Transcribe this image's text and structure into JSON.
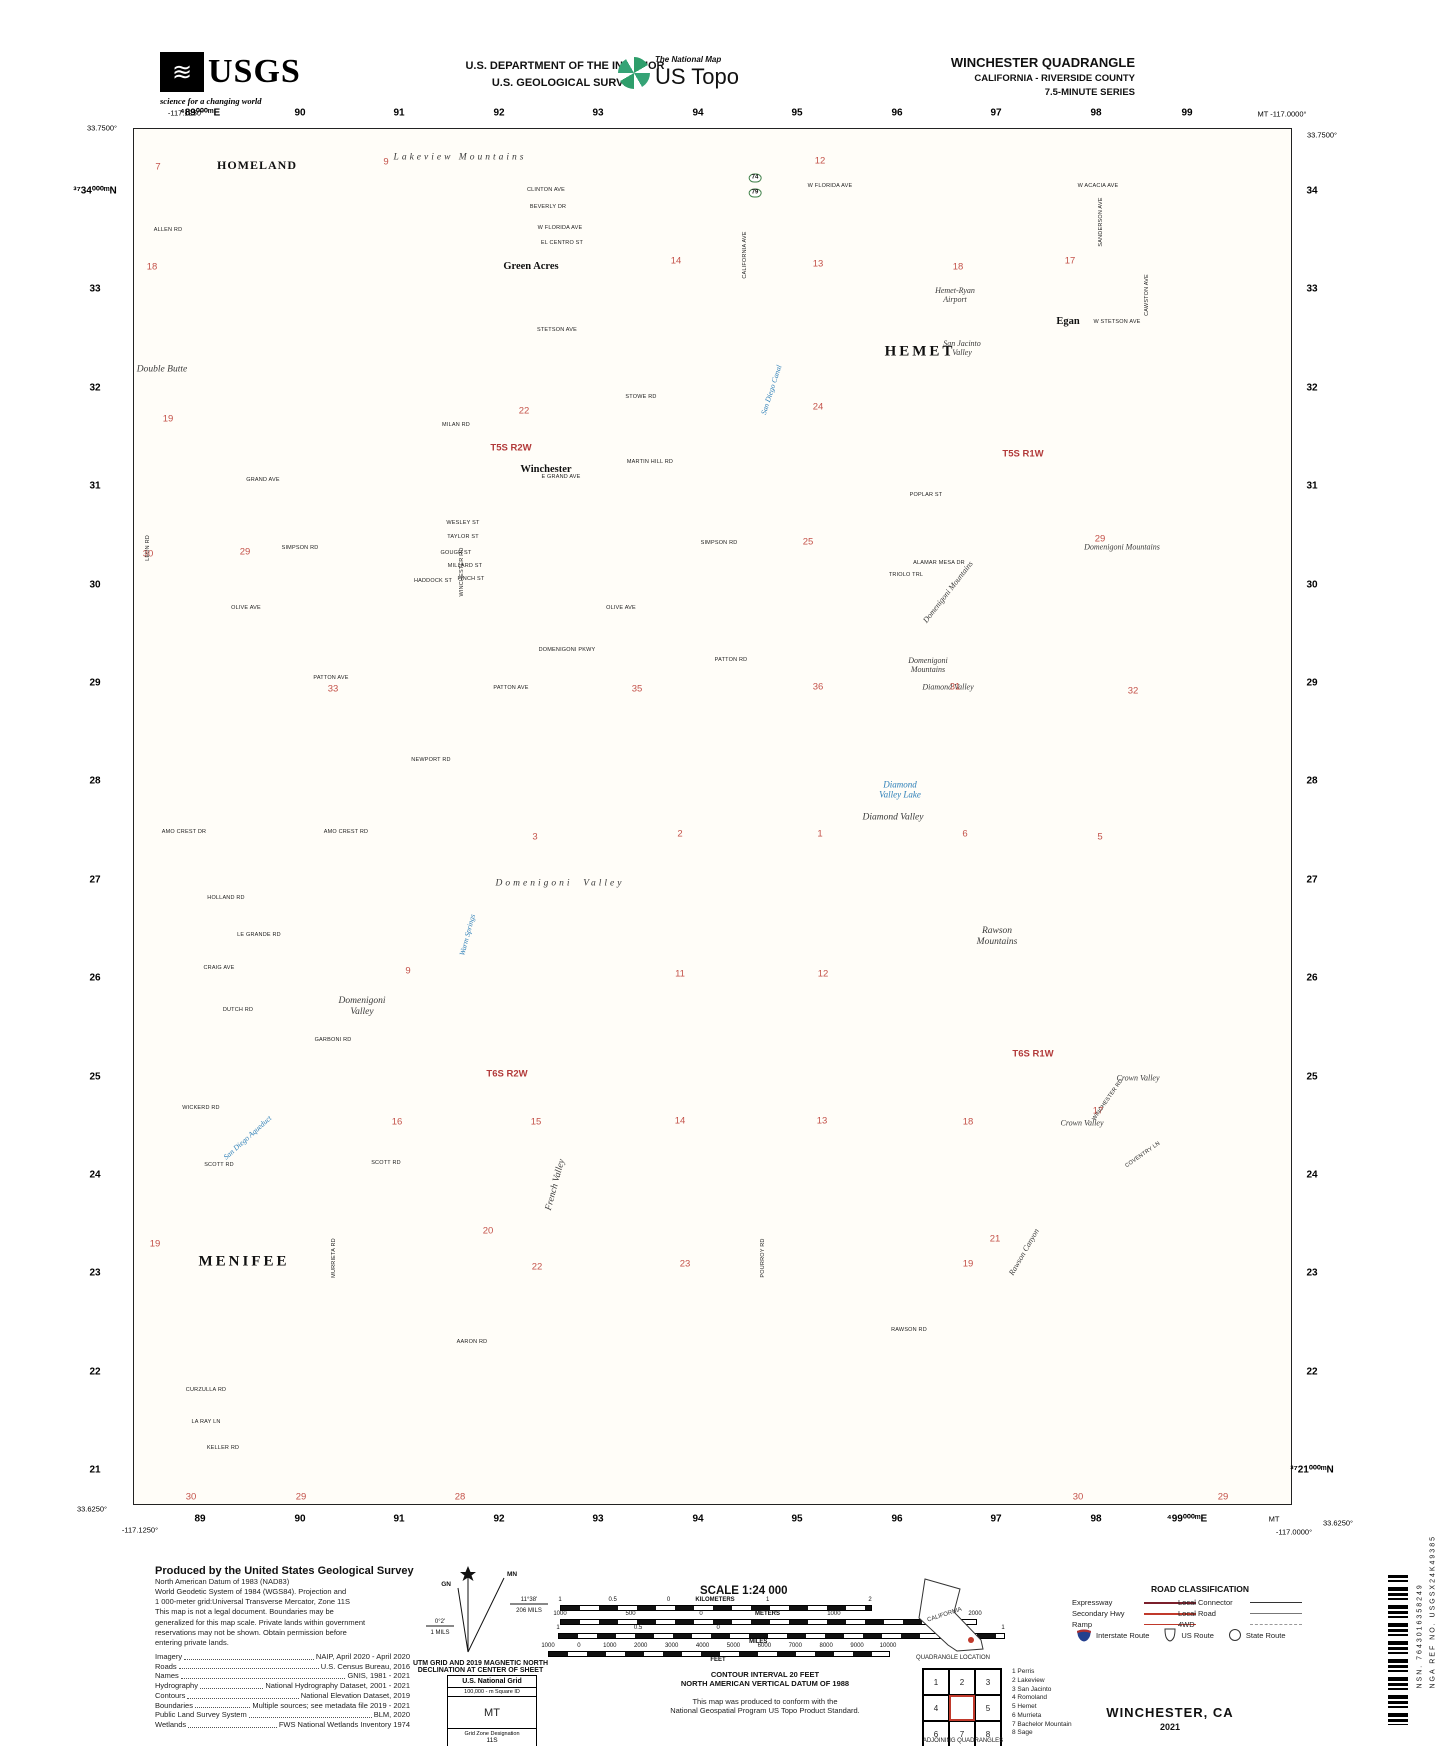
{
  "header": {
    "usgs_logo": "USGS",
    "usgs_wave": "≋",
    "usgs_tagline": "science for a changing world",
    "dept_line1": "U.S. DEPARTMENT OF THE INTERIOR",
    "dept_line2": "U.S. GEOLOGICAL SURVEY",
    "natmap_label": "The National Map",
    "ustopo_label": "US Topo",
    "quad_title": "WINCHESTER QUADRANGLE",
    "quad_subtitle": "CALIFORNIA - RIVERSIDE COUNTY",
    "quad_series": "7.5-MINUTE SERIES"
  },
  "map": {
    "corners": {
      "tl_lon": "-117.1250°",
      "tl_lat": "33.7500°",
      "tr_lon": "MT -117.0000°",
      "tr_lat": "33.7500°",
      "bl_lat": "33.6250°",
      "bl_lon": "-117.1250°",
      "br_mt": "MT",
      "br_lon": "-117.0000°",
      "br_lat": "33.6250°"
    },
    "grid_top": [
      "⁴89⁰⁰⁰ᵐE",
      "90",
      "91",
      "92",
      "93",
      "94",
      "95",
      "96",
      "97",
      "98",
      "99"
    ],
    "grid_bottom": [
      "89",
      "90",
      "91",
      "92",
      "93",
      "94",
      "95",
      "96",
      "97",
      "98",
      "⁴99⁰⁰⁰ᵐE"
    ],
    "grid_left": [
      "³⁷34⁰⁰⁰ᵐN",
      "33",
      "32",
      "31",
      "30",
      "29",
      "28",
      "27",
      "26",
      "25",
      "24",
      "23",
      "22",
      "21"
    ],
    "grid_right": [
      "34",
      "33",
      "32",
      "31",
      "30",
      "29",
      "28",
      "27",
      "26",
      "25",
      "24",
      "23",
      "22",
      "³⁷21⁰⁰⁰ᵐN"
    ],
    "labels": [
      {
        "t": "HOMELAND",
        "x": 257,
        "y": 166,
        "c": "town"
      },
      {
        "t": "Green Acres",
        "x": 531,
        "y": 267,
        "c": "town2"
      },
      {
        "t": "HEMET",
        "x": 920,
        "y": 352,
        "c": "town1"
      },
      {
        "t": "Egan",
        "x": 1068,
        "y": 322,
        "c": "town2"
      },
      {
        "t": "Winchester",
        "x": 546,
        "y": 470,
        "c": "town2"
      },
      {
        "t": "MENIFEE",
        "x": 244,
        "y": 1262,
        "c": "town1"
      },
      {
        "t": "Lakeview Mountains",
        "x": 460,
        "y": 158,
        "c": "feat fsp"
      },
      {
        "t": "Double Butte",
        "x": 162,
        "y": 370,
        "c": "feat"
      },
      {
        "t": "San Jacinto\nValley",
        "x": 962,
        "y": 348,
        "c": "feat fsm"
      },
      {
        "t": "Hemet-Ryan\nAirport",
        "x": 955,
        "y": 295,
        "c": "feat fsm"
      },
      {
        "t": "Domenigoni Mountains",
        "x": 1122,
        "y": 547,
        "c": "feat fsm"
      },
      {
        "t": "Domenigoni Mountains",
        "x": 948,
        "y": 592,
        "c": "feat fsm",
        "r": -52
      },
      {
        "t": "Domenigoni\nMountains",
        "x": 928,
        "y": 665,
        "c": "feat fsm"
      },
      {
        "t": "Diamond Valley",
        "x": 948,
        "y": 687,
        "c": "feat fsm"
      },
      {
        "t": "Diamond\nValley Lake",
        "x": 900,
        "y": 790,
        "c": "water"
      },
      {
        "t": "Diamond Valley",
        "x": 893,
        "y": 818,
        "c": "feat"
      },
      {
        "t": "Domenigoni  Valley",
        "x": 560,
        "y": 884,
        "c": "feat fsp"
      },
      {
        "t": "Rawson\nMountains",
        "x": 997,
        "y": 937,
        "c": "feat"
      },
      {
        "t": "Domenigoni\nValley",
        "x": 362,
        "y": 1007,
        "c": "feat"
      },
      {
        "t": "Crown Valley",
        "x": 1138,
        "y": 1078,
        "c": "feat fsm"
      },
      {
        "t": "Crown Valley",
        "x": 1082,
        "y": 1123,
        "c": "feat fsm"
      },
      {
        "t": "French Valley",
        "x": 556,
        "y": 1185,
        "c": "feat",
        "r": -75
      },
      {
        "t": "Rawson Canyon",
        "x": 1024,
        "y": 1252,
        "c": "feat fsm",
        "r": -60
      },
      {
        "t": "Warm Springs",
        "x": 468,
        "y": 935,
        "c": "water wsm",
        "r": -75
      },
      {
        "t": "San Diego Canal",
        "x": 772,
        "y": 390,
        "c": "water wsm",
        "r": -72
      },
      {
        "t": "San Diego Aqueduct",
        "x": 248,
        "y": 1138,
        "c": "water wsm",
        "r": -42
      },
      {
        "t": "T5S R2W",
        "x": 511,
        "y": 449,
        "c": "plss"
      },
      {
        "t": "T5S R1W",
        "x": 1023,
        "y": 455,
        "c": "plss"
      },
      {
        "t": "T6S R2W",
        "x": 507,
        "y": 1075,
        "c": "plss"
      },
      {
        "t": "T6S R1W",
        "x": 1033,
        "y": 1055,
        "c": "plss"
      },
      {
        "t": "74",
        "x": 755,
        "y": 178,
        "c": "shield"
      },
      {
        "t": "79",
        "x": 755,
        "y": 193,
        "c": "shield"
      }
    ],
    "sections": [
      [
        158,
        168,
        "7"
      ],
      [
        386,
        163,
        "9"
      ],
      [
        820,
        162,
        "12"
      ],
      [
        152,
        268,
        "18"
      ],
      [
        676,
        262,
        "14"
      ],
      [
        818,
        265,
        "13"
      ],
      [
        958,
        268,
        "18"
      ],
      [
        1070,
        262,
        "17"
      ],
      [
        168,
        420,
        "19"
      ],
      [
        524,
        412,
        "22"
      ],
      [
        818,
        408,
        "24"
      ],
      [
        148,
        555,
        "30"
      ],
      [
        245,
        553,
        "29"
      ],
      [
        808,
        543,
        "25"
      ],
      [
        1100,
        540,
        "29"
      ],
      [
        333,
        690,
        "33"
      ],
      [
        637,
        690,
        "35"
      ],
      [
        818,
        688,
        "36"
      ],
      [
        955,
        688,
        "31"
      ],
      [
        1133,
        692,
        "32"
      ],
      [
        535,
        838,
        "3"
      ],
      [
        680,
        835,
        "2"
      ],
      [
        820,
        835,
        "1"
      ],
      [
        965,
        835,
        "6"
      ],
      [
        1100,
        838,
        "5"
      ],
      [
        408,
        972,
        "9"
      ],
      [
        680,
        975,
        "11"
      ],
      [
        823,
        975,
        "12"
      ],
      [
        397,
        1123,
        "16"
      ],
      [
        536,
        1123,
        "15"
      ],
      [
        680,
        1122,
        "14"
      ],
      [
        822,
        1122,
        "13"
      ],
      [
        968,
        1123,
        "18"
      ],
      [
        1098,
        1112,
        "17"
      ],
      [
        488,
        1232,
        "20"
      ],
      [
        155,
        1245,
        "19"
      ],
      [
        995,
        1240,
        "21"
      ],
      [
        537,
        1268,
        "22"
      ],
      [
        685,
        1265,
        "23"
      ],
      [
        968,
        1265,
        "19"
      ],
      [
        191,
        1498,
        "30"
      ],
      [
        301,
        1498,
        "29"
      ],
      [
        460,
        1498,
        "28"
      ],
      [
        1078,
        1498,
        "30"
      ],
      [
        1223,
        1498,
        "29"
      ]
    ],
    "roads": [
      [
        830,
        186,
        "W FLORIDA AVE"
      ],
      [
        546,
        190,
        "CLINTON AVE"
      ],
      [
        548,
        207,
        "BEVERLY DR"
      ],
      [
        1098,
        186,
        "W ACACIA AVE"
      ],
      [
        168,
        230,
        "ALLEN RD"
      ],
      [
        560,
        228,
        "W FLORIDA AVE"
      ],
      [
        562,
        243,
        "EL CENTRO ST"
      ],
      [
        557,
        330,
        "STETSON AVE"
      ],
      [
        1117,
        322,
        "W STETSON AVE"
      ],
      [
        641,
        397,
        "STOWE RD"
      ],
      [
        456,
        425,
        "MILAN RD"
      ],
      [
        263,
        480,
        "GRAND AVE"
      ],
      [
        561,
        477,
        "E GRAND AVE"
      ],
      [
        650,
        462,
        "MARTIN HILL RD"
      ],
      [
        926,
        495,
        "POPLAR ST"
      ],
      [
        300,
        548,
        "SIMPSON RD"
      ],
      [
        719,
        543,
        "SIMPSON RD"
      ],
      [
        463,
        523,
        "WESLEY ST"
      ],
      [
        463,
        537,
        "TAYLOR ST"
      ],
      [
        456,
        553,
        "GOUGH ST"
      ],
      [
        465,
        566,
        "MILLARD ST"
      ],
      [
        471,
        579,
        "FINCH ST"
      ],
      [
        433,
        581,
        "HADDOCK ST"
      ],
      [
        906,
        575,
        "TRIOLO TRL"
      ],
      [
        939,
        563,
        "ALAMAR MESA DR"
      ],
      [
        246,
        608,
        "OLIVE AVE"
      ],
      [
        621,
        608,
        "OLIVE AVE"
      ],
      [
        567,
        650,
        "DOMENIGONI PKWY"
      ],
      [
        731,
        660,
        "PATTON RD"
      ],
      [
        331,
        678,
        "PATTON AVE"
      ],
      [
        511,
        688,
        "PATTON AVE"
      ],
      [
        431,
        760,
        "NEWPORT RD"
      ],
      [
        184,
        832,
        "AMO CREST DR"
      ],
      [
        346,
        832,
        "AMO CREST RD"
      ],
      [
        226,
        898,
        "HOLLAND RD"
      ],
      [
        259,
        935,
        "LE GRANDE RD"
      ],
      [
        219,
        968,
        "CRAIG AVE"
      ],
      [
        238,
        1010,
        "DUTCH RD"
      ],
      [
        333,
        1040,
        "GARBONI RD"
      ],
      [
        201,
        1108,
        "WICKERD RD"
      ],
      [
        219,
        1165,
        "SCOTT RD"
      ],
      [
        386,
        1163,
        "SCOTT RD"
      ],
      [
        472,
        1342,
        "AARON RD"
      ],
      [
        206,
        1390,
        "CURZULLA RD"
      ],
      [
        223,
        1448,
        "KELLER RD"
      ],
      [
        206,
        1422,
        "LA RAY LN"
      ],
      [
        909,
        1330,
        "RAWSON RD"
      ],
      [
        148,
        548,
        "LEON RD",
        -90
      ],
      [
        334,
        1258,
        "MURRIETA RD",
        -90
      ],
      [
        763,
        1258,
        "POURROY RD",
        -90
      ],
      [
        462,
        572,
        "WINCHESTER RD",
        -90
      ],
      [
        1108,
        1100,
        "WINCHESTER RD",
        -55
      ],
      [
        1143,
        1155,
        "COVENTRY LN",
        -35
      ],
      [
        745,
        255,
        "CALIFORNIA AVE",
        -90
      ],
      [
        1101,
        222,
        "SANDERSON AVE",
        -90
      ],
      [
        1147,
        295,
        "CAWSTON AVE",
        -90
      ]
    ]
  },
  "footer": {
    "produced_title": "Produced by the United States Geological Survey",
    "datum_lines": [
      "North American Datum of 1983 (NAD83)",
      "World Geodetic System of 1984 (WGS84).  Projection and",
      "1 000-meter grid:Universal Transverse Mercator, Zone 11S",
      "This map is not a legal document. Boundaries may be",
      "generalized for this map scale. Private lands within government",
      "reservations may not be shown. Obtain permission before",
      "entering private lands."
    ],
    "credits": [
      [
        "Imagery",
        "NAIP, April 2020 - April 2020"
      ],
      [
        "Roads",
        "U.S. Census Bureau, 2016"
      ],
      [
        "Names",
        "GNIS, 1981 - 2021"
      ],
      [
        "Hydrography",
        "National Hydrography Dataset, 2001 - 2021"
      ],
      [
        "Contours",
        "National Elevation Dataset, 2019"
      ],
      [
        "Boundaries",
        "Multiple sources; see metadata file 2019 - 2021"
      ],
      [
        "Public Land Survey System",
        "BLM, 2020"
      ],
      [
        "Wetlands",
        "FWS National Wetlands Inventory 1974"
      ]
    ],
    "declination": {
      "caption1": "UTM GRID AND 2019 MAGNETIC NORTH",
      "caption2": "DECLINATION AT CENTER OF SHEET",
      "gn_label": "GN",
      "mn_label": "MN",
      "gn_deg": "0°2'",
      "gn_mils": "1 MILS",
      "mn_deg": "11°38'",
      "mn_mils": "206 MILS"
    },
    "usng": {
      "title": "U.S. National Grid",
      "sq_label": "100,000 - m Square ID",
      "square": "MT",
      "gzd_label": "Grid Zone Designation",
      "gzd": "11S"
    },
    "scale": {
      "title": "SCALE 1:24 000",
      "km_labels": [
        "1",
        "0.5",
        "0",
        "1",
        "2"
      ],
      "km_unit": "KILOMETERS",
      "m_labels": [
        "1000",
        "500",
        "0",
        "1000",
        "2000"
      ],
      "m_unit": "METERS",
      "mi_labels": [
        "1",
        "0.5",
        "0",
        "1"
      ],
      "mi_unit": "MILES",
      "ft_labels": [
        "1000",
        "0",
        "1000",
        "2000",
        "3000",
        "4000",
        "5000",
        "6000",
        "7000",
        "8000",
        "9000",
        "10000"
      ],
      "ft_unit": "FEET"
    },
    "contour_line1": "CONTOUR INTERVAL 20 FEET",
    "contour_line2": "NORTH AMERICAN VERTICAL DATUM OF 1988",
    "standard_line1": "This map was produced to conform with the",
    "standard_line2": "National Geospatial Program US Topo Product Standard.",
    "california": {
      "state": "CALIFORNIA",
      "caption": "QUADRANGLE LOCATION"
    },
    "adjoining": {
      "cells": [
        "1",
        "2",
        "3",
        "4",
        "",
        "5",
        "6",
        "7",
        "8"
      ],
      "names": [
        "1 Perris",
        "2 Lakeview",
        "3 San Jacinto",
        "4 Romoland",
        "5 Hemet",
        "6 Murrieta",
        "7 Bachelor Mountain",
        "8 Sage"
      ],
      "caption": "ADJOINING QUADRANGLES"
    },
    "roadclass": {
      "title": "ROAD CLASSIFICATION",
      "rows_left": [
        [
          "Expressway",
          "expressway"
        ],
        [
          "Secondary Hwy",
          "secondary"
        ],
        [
          "Ramp",
          "ramp"
        ]
      ],
      "rows_right": [
        [
          "Local Connector",
          "connector"
        ],
        [
          "Local Road",
          "local"
        ],
        [
          "4WD",
          "fourwd"
        ]
      ],
      "shields": [
        [
          "Interstate Route",
          "interstate"
        ],
        [
          "US Route",
          "usroute"
        ],
        [
          "State Route",
          "stateroute"
        ]
      ]
    },
    "sheet_title": "WINCHESTER, CA",
    "sheet_year": "2021",
    "nsn": "NSN. 7643016358249",
    "nga": "NGA REF NO. USGSX24K49385"
  }
}
